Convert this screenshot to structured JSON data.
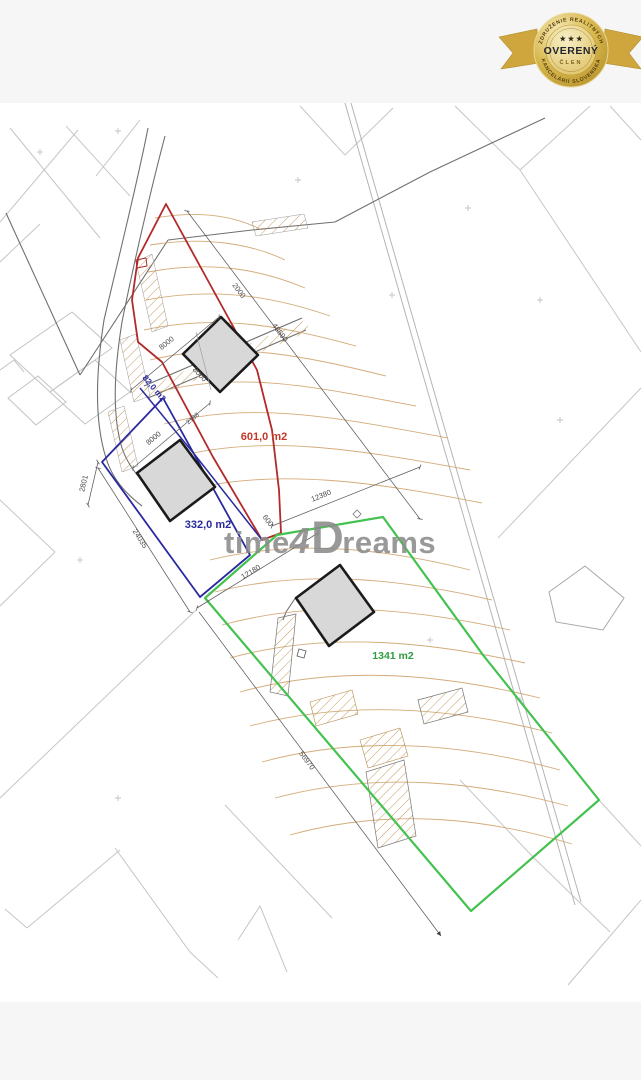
{
  "badge": {
    "arc_top": "ZDRUŽENIE REALITNÝCH",
    "arc_bottom": "KANCELÁRIÍ SLOVENSKA",
    "title": "OVERENÝ",
    "member": "ČLEN",
    "stars": "★ ★ ★"
  },
  "watermark": {
    "t1": "time",
    "t2": "4",
    "t3": "D",
    "t4": "reams"
  },
  "areas": {
    "red": "601,0 m2",
    "blue": "332,0 m2",
    "blue_strip": "82,0 m2",
    "green": "1341 m2"
  },
  "dims": {
    "b1_top": "8000",
    "b1_side": "8000",
    "red_len": "48590",
    "red_width": "2000",
    "b2_top": "8000",
    "b2_ext": "2138",
    "blue_w": "2801",
    "blue_sw": "24035",
    "green_nw": "12180",
    "junction": "600",
    "green_n": "12380",
    "green_sw": "56970"
  },
  "colors": {
    "red": "#b22a2a",
    "blue": "#2a2aa0",
    "green": "#44c24f",
    "gold": "#cfa63d"
  }
}
